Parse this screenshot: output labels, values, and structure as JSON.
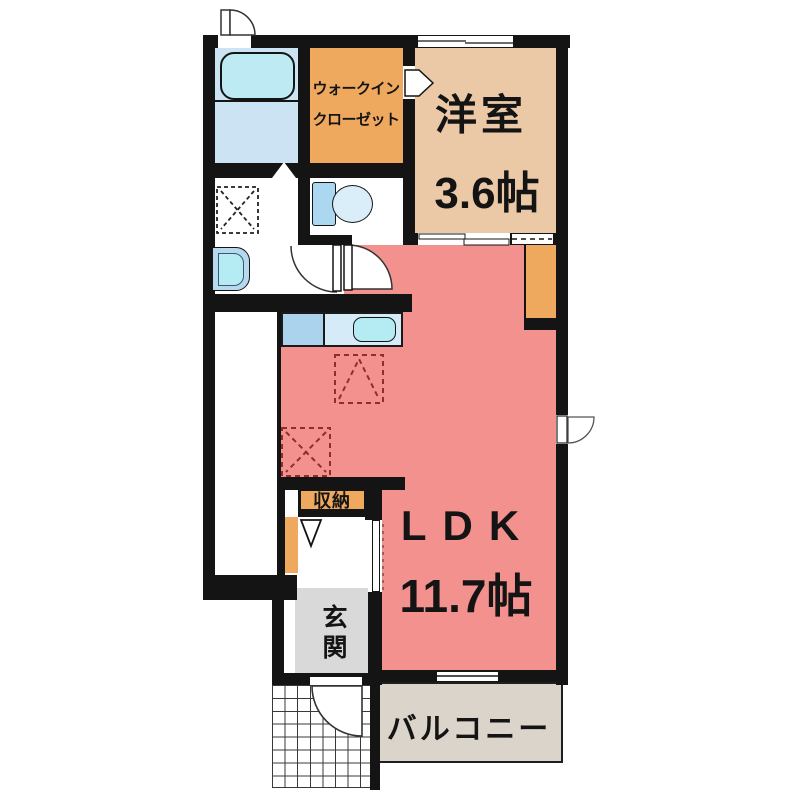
{
  "rooms": {
    "western_room": {
      "name": "洋室",
      "size": "3.6帖"
    },
    "ldk": {
      "name": "LDK",
      "size": "11.7帖"
    },
    "walk_in_closet": {
      "line1": "ウォークイン",
      "line2": "クローゼット"
    },
    "storage": {
      "name": "収納"
    },
    "entrance": {
      "name": "玄関"
    },
    "balcony": {
      "name": "バルコニー"
    }
  },
  "fixtures": [
    "bathtub-icon",
    "toilet-icon",
    "washbasin-icon",
    "kitchen-sink-icon",
    "washing-machine-space-icon",
    "refrigerator-space-icon",
    "door-swing-icon",
    "sliding-window-icon",
    "entrance-step-icon",
    "porch-tile-grid"
  ],
  "colors": {
    "ldk_pink": "#F2918D",
    "western_room_tan": "#EBC9A6",
    "closet_orange": "#EFA95E",
    "bathroom_blue": "#CBE3F2",
    "fixture_cyan": "#BEEAF4",
    "counter_blue": "#ACD3EE",
    "counter_light_blue": "#D6EBF8",
    "entrance_gray": "#D9D9D9",
    "balcony_beige": "#DBD4CB",
    "wall_black": "#141414",
    "marker_dashed_red": "#8F2F2B"
  }
}
